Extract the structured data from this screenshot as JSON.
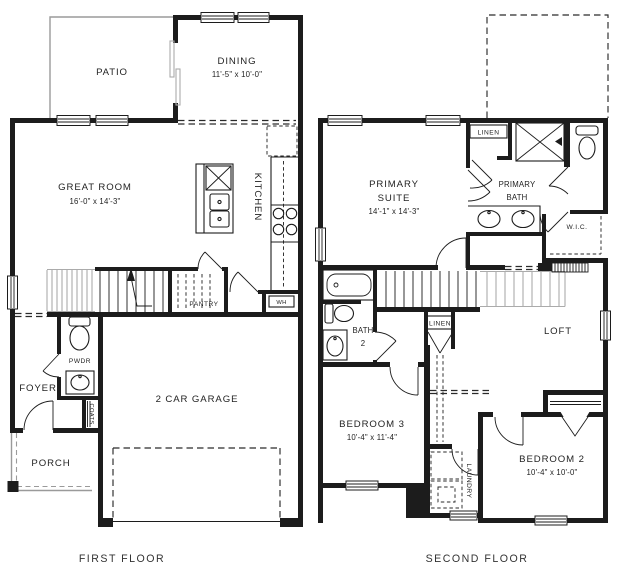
{
  "first_floor": {
    "caption": "FIRST FLOOR",
    "rooms": {
      "patio": "PATIO",
      "dining": "DINING",
      "dining_dims": "11'-5\" x 10'-0\"",
      "great_room": "GREAT ROOM",
      "great_room_dims": "16'-0\" x 14'-3\"",
      "kitchen": "KITCHEN",
      "pantry": "PANTRY",
      "water_heater": "WH",
      "powder": "PWDR",
      "foyer": "FOYER",
      "coats": "COATS",
      "porch": "PORCH",
      "garage": "2 CAR GARAGE"
    }
  },
  "second_floor": {
    "caption": "SECOND FLOOR",
    "rooms": {
      "primary_suite_line1": "PRIMARY",
      "primary_suite_line2": "SUITE",
      "primary_suite_dims": "14'-1\" x 14'-3\"",
      "primary_linen": "LINEN",
      "primary_bath_line1": "PRIMARY",
      "primary_bath_line2": "BATH",
      "wic": "W.I.C.",
      "bath2_line1": "BATH",
      "bath2_line2": "2",
      "hall_linen": "LINEN",
      "loft": "LOFT",
      "bedroom3": "BEDROOM 3",
      "bedroom3_dims": "10'-4\" x 11'-4\"",
      "laundry": "LAUNDRY",
      "bedroom2": "BEDROOM 2",
      "bedroom2_dims": "10'-4\" x 10'-0\""
    }
  },
  "colors": {
    "wall": "#1c1c1c",
    "secondary_gray": "#9a9a9a",
    "background": "#ffffff",
    "text": "#232323"
  }
}
